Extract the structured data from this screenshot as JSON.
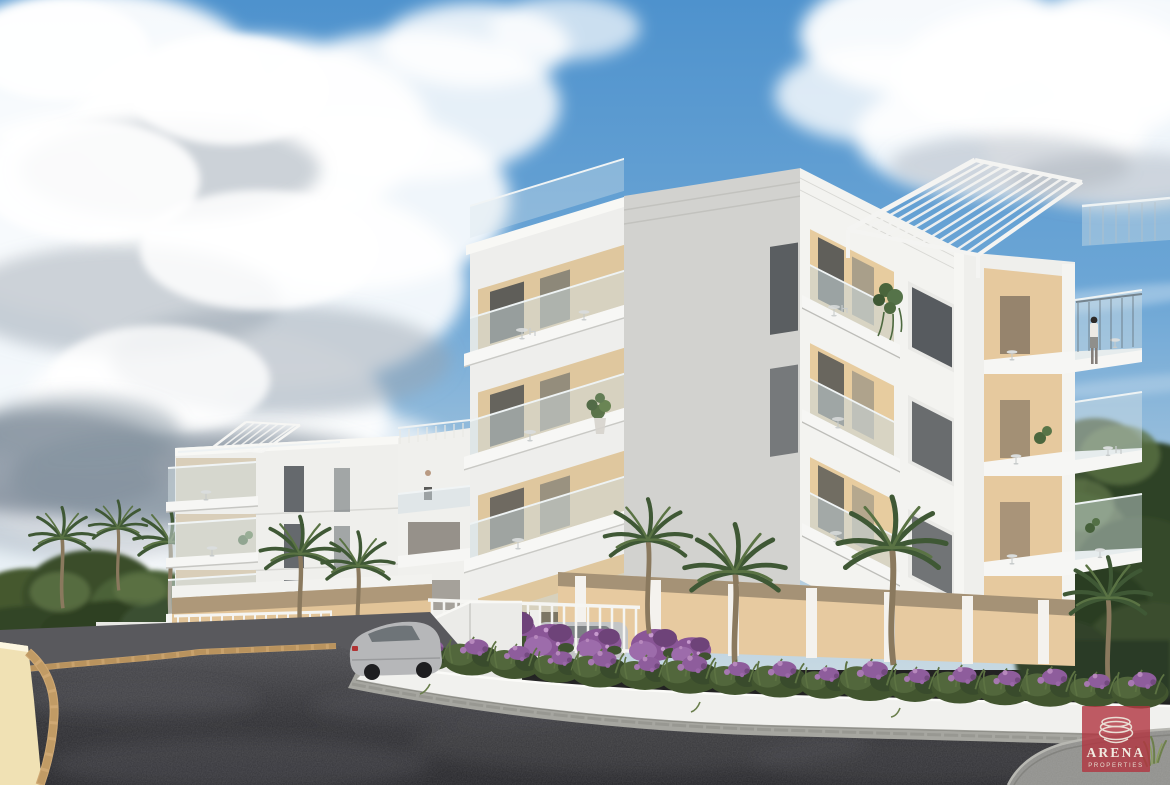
{
  "image": {
    "type": "architectural-render",
    "subject": "Modern white apartment complex exterior 3D visualization with palm trees and driveway",
    "width_px": 1170,
    "height_px": 785
  },
  "watermark": {
    "brand": "ARENA",
    "tagline": "PROPERTIES",
    "icon": "stacked-ellipse-bowl-icon",
    "background_color": "#b23540",
    "text_color": "#f1ebe1"
  },
  "palette": {
    "sky_top": "#4e92cd",
    "sky_horizon": "#c6d8e2",
    "cloud_white": "#ffffff",
    "cloud_shadow": "#8593a0",
    "building_white": "#f3f3f0",
    "building_shadow_face": "#d2d2cf",
    "terrace_beige": "#e7cc9f",
    "balcony_glass": "#ccdae0",
    "foliage_dark": "#33462b",
    "foliage_light": "#678049",
    "bougainvillea_purple": "#96619f",
    "asphalt": "#303034",
    "planter_wall_white": "#f1f1ee",
    "kerb_beige": "#c9a26c"
  },
  "scene": {
    "sky_label": "blue sky with cumulus clouds",
    "buildings": [
      {
        "label": "left apartment block",
        "floors_visible": 4
      },
      {
        "label": "main apartment block",
        "floors_visible": 4,
        "features": [
          "roof pergola",
          "glass balconies",
          "recessed beige terraces"
        ]
      }
    ],
    "figures": [
      {
        "label": "woman standing on upper right balcony"
      },
      {
        "label": "man on left roof terrace"
      },
      {
        "label": "man on left building balcony"
      }
    ],
    "vehicles": {
      "parked_cars_visible": 7
    },
    "foreground_label": "dark asphalt driveway with curved white planter wall",
    "vegetation": [
      "palm trees",
      "clipped shrubs",
      "purple bougainvillea"
    ]
  }
}
